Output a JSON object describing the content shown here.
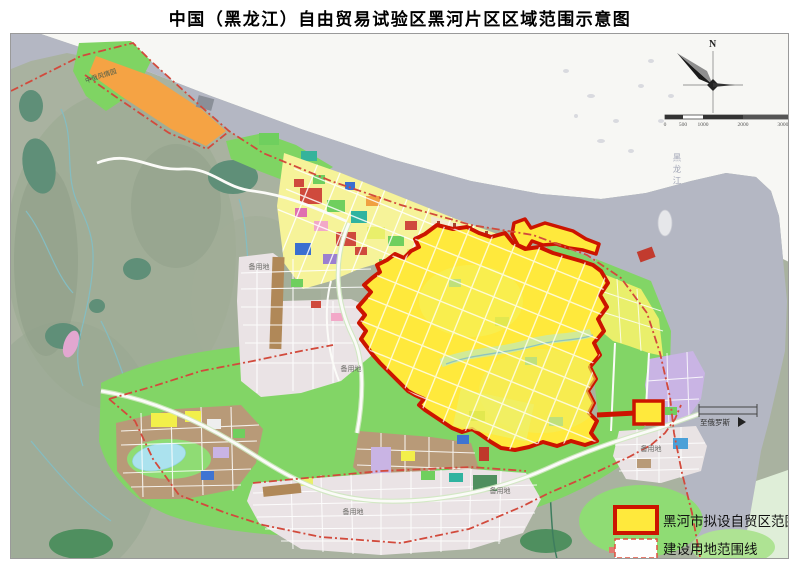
{
  "title": "中国（黑龙江）自由贸易试验区黑河片区区域范围示意图",
  "map": {
    "labels": {
      "park": "中俄风情园",
      "reserve_land": "备用地",
      "to_russia": "至俄罗斯",
      "river": "黑龙江"
    },
    "compass": {
      "north": "N"
    },
    "scale_bar": {
      "ticks": [
        "0",
        "500",
        "1000",
        "2000",
        "3000m"
      ]
    },
    "legend": {
      "items": [
        {
          "label": "黑河市拟设自贸区范围",
          "swatch": "yellow-fill-thick-red-border"
        },
        {
          "label": "建设用地范围线",
          "swatch": "white-fill-red-dashed-border"
        }
      ]
    },
    "colors": {
      "ftz_fill": "#ffe93c",
      "ftz_border": "#cc1400",
      "construction_boundary_line": "#d24a3c",
      "river": "#b4b7c3",
      "terrain": "#a9b2a0",
      "plain_green": "#82d566",
      "far_bank": "#f7f7f4",
      "reserve_grid": "#eae3e5",
      "brown_blocks": "#b89a78"
    }
  }
}
